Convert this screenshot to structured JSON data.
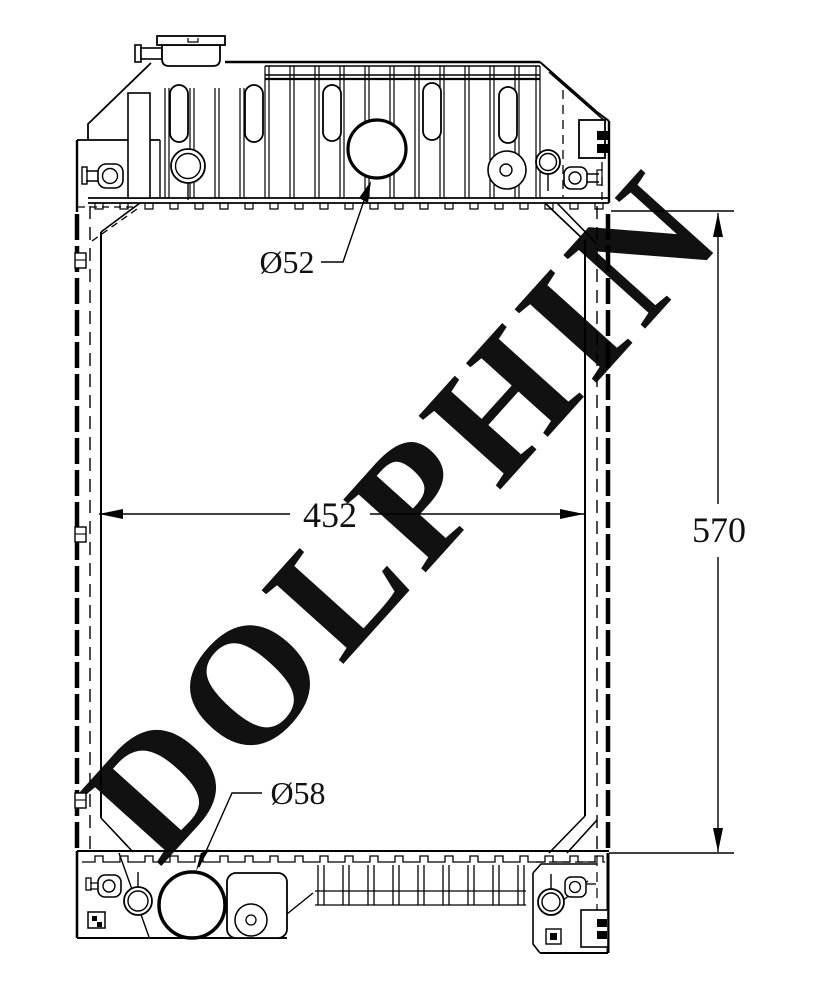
{
  "watermark": {
    "text": "DOLPHIN",
    "color": "#f3dcd6"
  },
  "labels": {
    "inlet_diameter": "Ø52",
    "outlet_diameter": "Ø58",
    "core_width": "452",
    "core_height": "570"
  },
  "colors": {
    "line": "#000000",
    "background": "#ffffff"
  }
}
